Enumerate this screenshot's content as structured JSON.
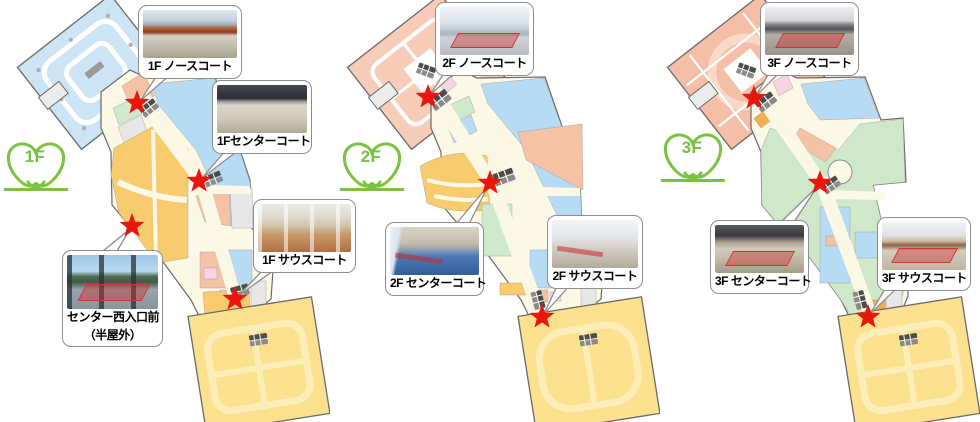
{
  "page": {
    "background": "#ffffff",
    "description_colors": {
      "star_red": "#e8160c",
      "logo_green": "#76c043",
      "parking_blue": "#cde4f5",
      "shop_blue": "#b7dbf2",
      "salmon": "#f5c2a6",
      "shop_yellow": "#f7cb6e",
      "anchor_yellow": "#fbe08e",
      "shop_green": "#cfe9cc",
      "shop_pink": "#f8d3e5",
      "concourse_cream": "#fcf8e6",
      "callout_border": "#8e8e8e"
    }
  },
  "floors": [
    {
      "logo_label": "1F",
      "callouts": {
        "north": {
          "label": "1F ノースコート"
        },
        "center": {
          "label": "1Fセンターコート"
        },
        "south": {
          "label": "1F サウスコート"
        },
        "west": {
          "label_line1": "センター西入口前",
          "label_line2": "（半屋外）"
        }
      }
    },
    {
      "logo_label": "2F",
      "callouts": {
        "north": {
          "label": "2F ノースコート"
        },
        "center": {
          "label": "2F センターコート"
        },
        "south": {
          "label": "2F サウスコート"
        }
      }
    },
    {
      "logo_label": "3F",
      "callouts": {
        "north": {
          "label": "3F ノースコート"
        },
        "center": {
          "label": "3F センターコート"
        },
        "south": {
          "label": "3F サウスコート"
        }
      }
    }
  ]
}
